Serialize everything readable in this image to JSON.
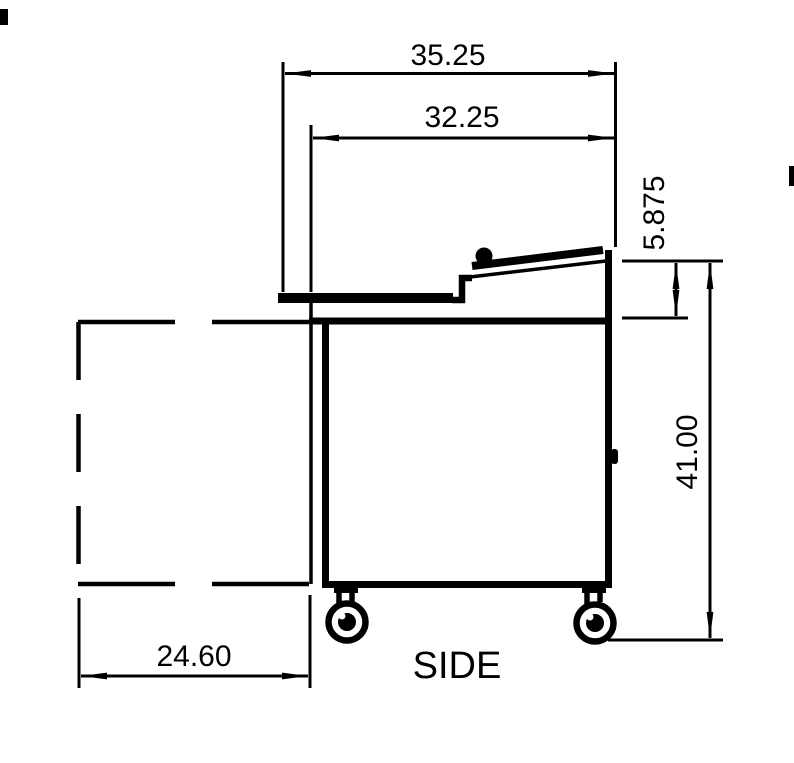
{
  "view_label": "SIDE",
  "dimensions": [
    {
      "name": "overall-depth",
      "value": "35.25",
      "orientation": "horizontal"
    },
    {
      "name": "top-depth",
      "value": "32.25",
      "orientation": "horizontal"
    },
    {
      "name": "lid-riser-height",
      "value": "5.875",
      "orientation": "vertical"
    },
    {
      "name": "overall-height",
      "value": "41.00",
      "orientation": "vertical"
    },
    {
      "name": "door-swing-clearance",
      "value": "24.60",
      "orientation": "horizontal"
    }
  ],
  "colors": {
    "line": "#000000",
    "background": "#ffffff",
    "text": "#000000"
  }
}
